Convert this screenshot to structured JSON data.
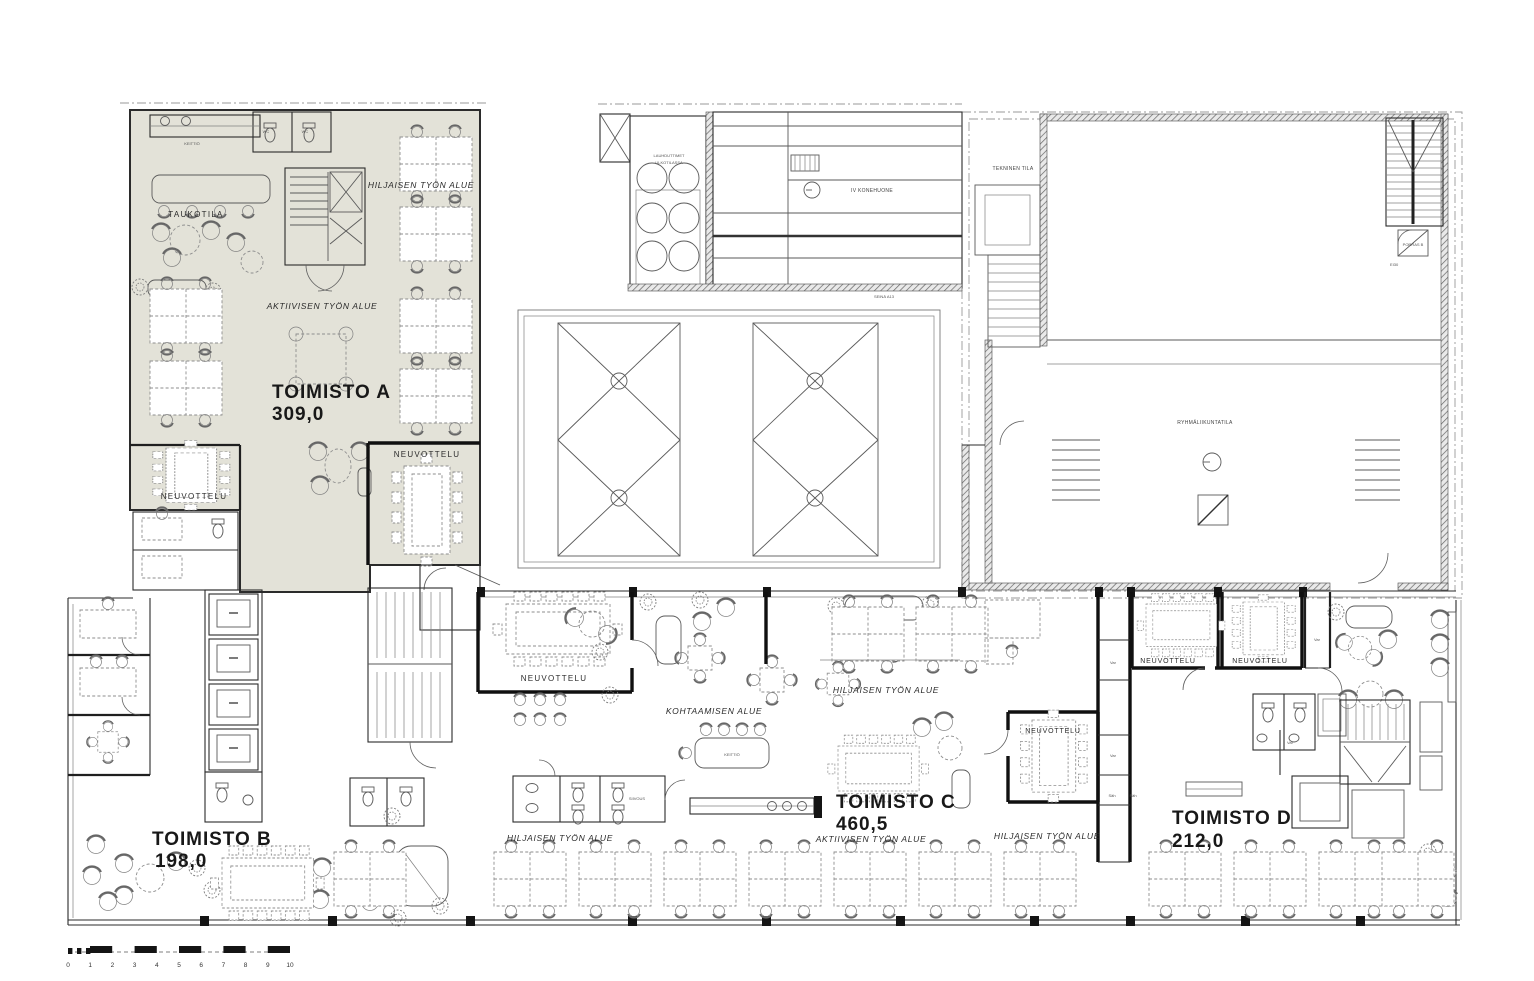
{
  "meta": {
    "drawing_type": "office floor plan"
  },
  "offices": {
    "a": {
      "name": "TOIMISTO A",
      "area": "309,0"
    },
    "b": {
      "name": "TOIMISTO B",
      "area": "198,0"
    },
    "c": {
      "name": "TOIMISTO C",
      "area": "460,5"
    },
    "d": {
      "name": "TOIMISTO D",
      "area": "212,0"
    }
  },
  "labels": {
    "taukotila": "TAUKOTILA",
    "keittio": "KEITTIÖ",
    "wc": "WC",
    "neuvottelu": "NEUVOTTELU",
    "hiljaisen_tyon_alue": "HILJAISEN TYÖN ALUE",
    "aktiivisen_tyon_alue": "AKTIIVISEN TYÖN ALUE",
    "kohtaamisen_alue": "KOHTAAMISEN ALUE",
    "siivous": "SIIVOUS",
    "lauhduttimet_line1": "LAUHDUTTIMET",
    "lauhduttimet_line2": "ULKOTILASSA",
    "iv_konehuone": "IV KONEHUONE",
    "seina_a13": "SEINÄ A13",
    "tekninen_tila": "TEKNINEN TILA",
    "ryhmaliikuntatila": "RYHMÄLIIKUNTATILA",
    "porras_b": "PORRAS B",
    "ei30": "EI30",
    "var": "Var",
    "sah": "Säh"
  },
  "scale": {
    "ticks": [
      "0",
      "1",
      "2",
      "3",
      "4",
      "5",
      "6",
      "7",
      "8",
      "9",
      "10"
    ]
  },
  "colors": {
    "paper": "#ffffff",
    "office_a_fill": "#e3e2d8",
    "wall": "#1f1f1f",
    "furniture": "#8e8e8e"
  }
}
